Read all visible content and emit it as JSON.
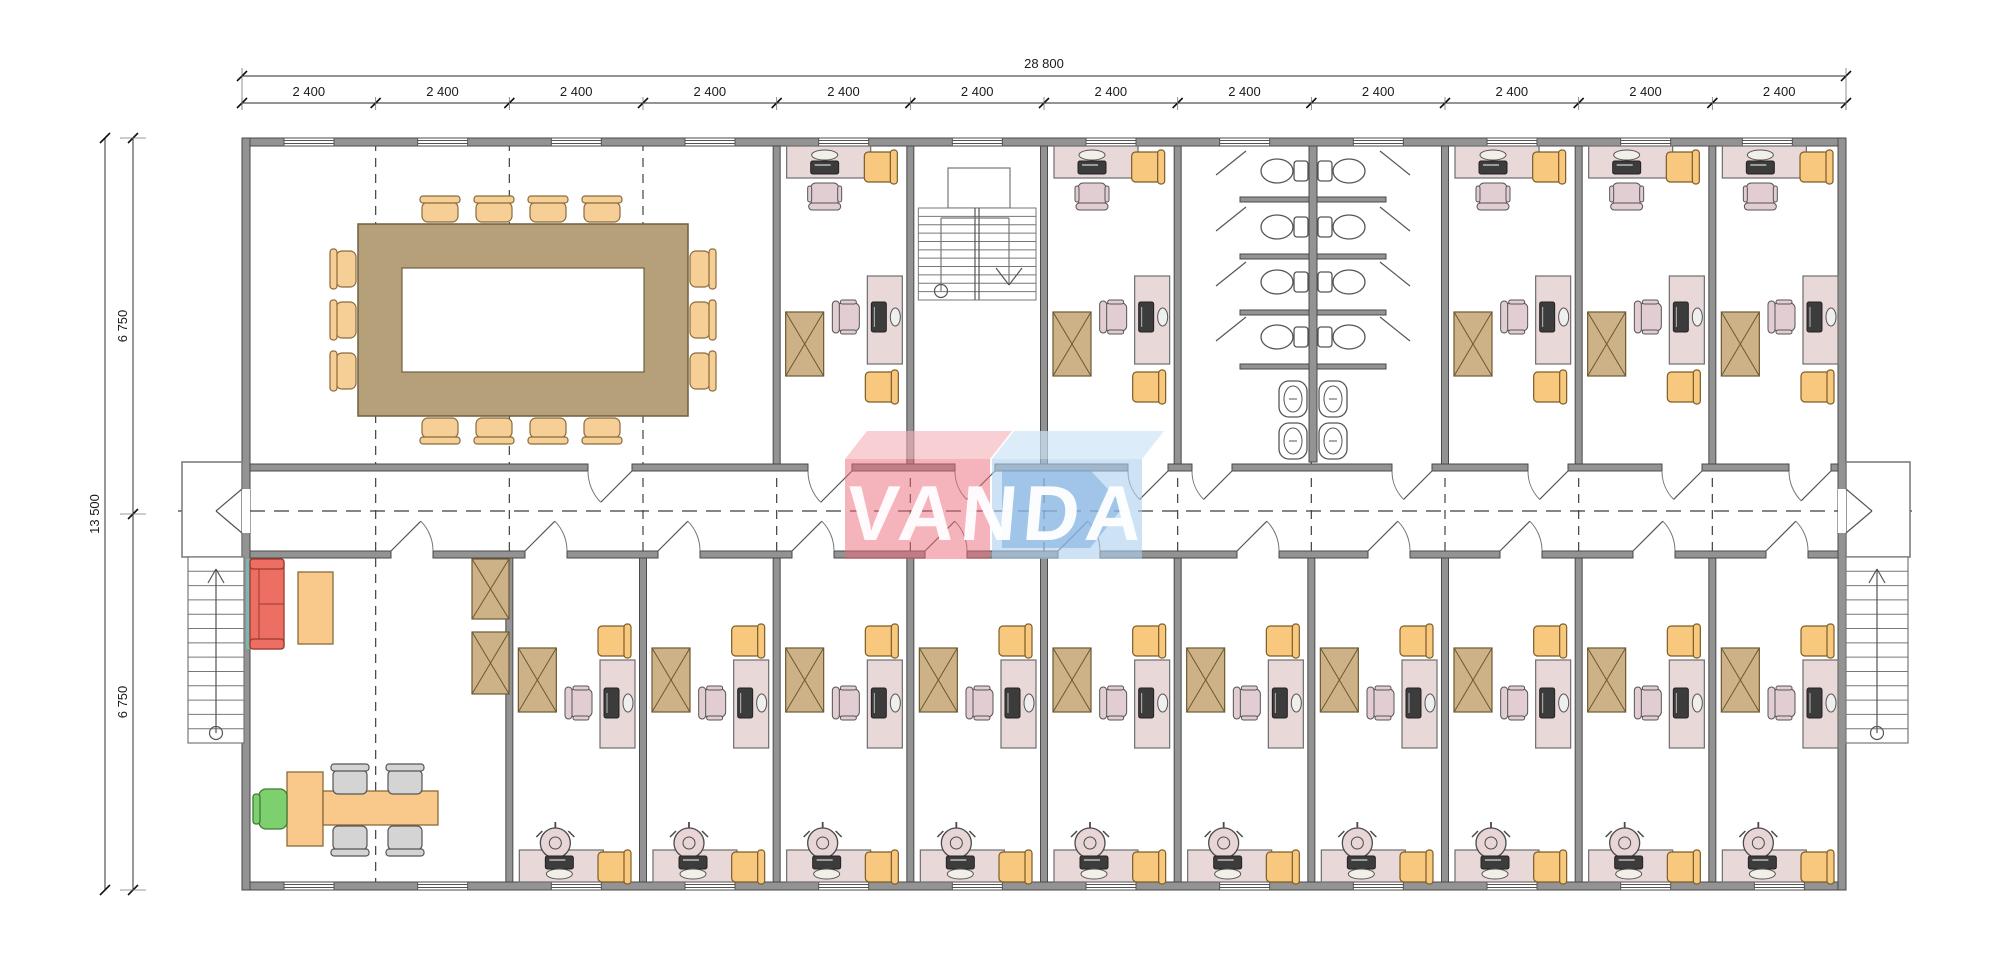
{
  "drawing": {
    "kind": "modular office building floor plan",
    "logo": {
      "text": "VANDA",
      "pink_main": "rgba(236,106,120,0.50)",
      "pink_top": "rgba(243,176,184,0.60)",
      "blue_main": "rgba(172,206,236,0.60)",
      "blue_top": "rgba(206,228,246,0.70)",
      "blue_glyph": "rgba(118,168,220,0.50)",
      "text_color": "rgba(255,255,255,0.95)"
    },
    "dimensions": {
      "top_total": "28 800",
      "top_segments": [
        "2 400",
        "2 400",
        "2 400",
        "2 400",
        "2 400",
        "2 400",
        "2 400",
        "2 400",
        "2 400",
        "2 400",
        "2 400",
        "2 400"
      ],
      "left_total": "13 500",
      "left_segments": [
        "6 750",
        "6 750"
      ]
    },
    "building": {
      "modules": 12,
      "top_band_rooms": [
        "meeting-room",
        "office",
        "stairwell",
        "office",
        "wc-block",
        "office",
        "office",
        "office"
      ],
      "bottom_band_rooms": [
        "open-office",
        "office",
        "office",
        "office",
        "office",
        "office",
        "office",
        "office",
        "office",
        "office",
        "office"
      ],
      "top_office_modules": [
        4,
        6,
        9,
        10,
        11
      ],
      "bottom_office_modules": [
        2,
        3,
        4,
        5,
        6,
        7,
        8,
        9,
        10,
        11
      ],
      "meeting_room_chairs": 14,
      "wc_toilets": 8,
      "wc_sinks": 4,
      "entrances": 2,
      "external_stairs": 2
    },
    "palette": {
      "wall": "#939393",
      "wall_edge": "#4a4a4a",
      "line": "#555555",
      "thin": "#777777",
      "dash": "#3f3f3f",
      "dim_text": "#1a1a1a",
      "desk_pink": "#e9d8d8",
      "desk_edge": "#6d6d6d",
      "chair_pink": "#e2cdd3",
      "chair_yellow": "#f8c87e",
      "chair_yellow_edge": "#7c5d26",
      "wardrobe": "#cdb287",
      "wardrobe_edge": "#6d5832",
      "meet_table": "#b5a079",
      "meet_table_edge": "#6f5f3f",
      "meet_chair": "#f6cf97",
      "meet_chair_edge": "#8a6a3a",
      "sofa": "#ed6f63",
      "sofa_edge": "#9c392f",
      "orange": "#f9c98c",
      "orange_edge": "#8a6a3a",
      "gray_chair": "#d4d4d4",
      "green_chair": "#7ed06f",
      "green_edge": "#3f7a33",
      "device": "#3c3c3c",
      "teal": "#79b7b2"
    }
  }
}
